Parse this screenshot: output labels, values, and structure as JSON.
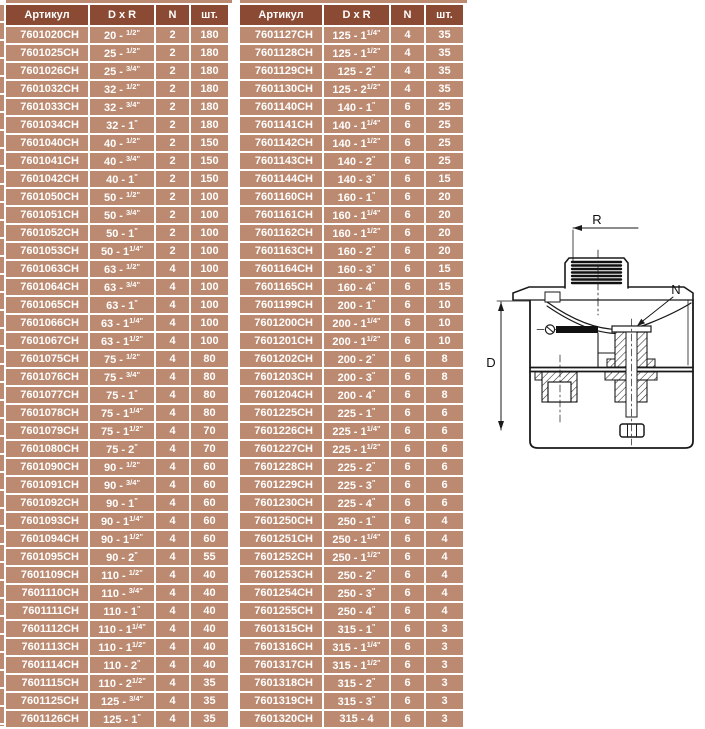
{
  "page": {
    "background": "#ffffff",
    "language": "ru"
  },
  "colors": {
    "header_bg": "#8b4a33",
    "row_bg": "#bc8a70",
    "separator": "#ffffff",
    "header_text": "#ffffff",
    "row_text": "#ffffff",
    "drawing_line": "#1a1a1a"
  },
  "tables": {
    "headers": [
      "Артикул",
      "D x R",
      "N",
      "шт."
    ],
    "left": {
      "rows": [
        [
          "7601020CH",
          "20 - {1/2\"}",
          "2",
          "180"
        ],
        [
          "7601025CH",
          "25 - {1/2\"}",
          "2",
          "180"
        ],
        [
          "7601026CH",
          "25 - {3/4\"}",
          "2",
          "180"
        ],
        [
          "7601032CH",
          "32 - {1/2\"}",
          "2",
          "180"
        ],
        [
          "7601033CH",
          "32 - {3/4\"}",
          "2",
          "180"
        ],
        [
          "7601034CH",
          "32 - 1{\"}",
          "2",
          "180"
        ],
        [
          "7601040CH",
          "40 - {1/2\"}",
          "2",
          "150"
        ],
        [
          "7601041CH",
          "40 - {3/4\"}",
          "2",
          "150"
        ],
        [
          "7601042CH",
          "40 - 1{\"}",
          "2",
          "150"
        ],
        [
          "7601050CH",
          "50 - {1/2\"}",
          "2",
          "100"
        ],
        [
          "7601051CH",
          "50 - {3/4\"}",
          "2",
          "100"
        ],
        [
          "7601052CH",
          "50 - 1{\"}",
          "2",
          "100"
        ],
        [
          "7601053CH",
          "50 - 1{1/4\"}",
          "2",
          "100"
        ],
        [
          "7601063CH",
          "63 - {1/2\"}",
          "4",
          "100"
        ],
        [
          "7601064CH",
          "63 - {3/4\"}",
          "4",
          "100"
        ],
        [
          "7601065CH",
          "63 - 1{\"}",
          "4",
          "100"
        ],
        [
          "7601066CH",
          "63 - 1{1/4\"}",
          "4",
          "100"
        ],
        [
          "7601067CH",
          "63 - 1{1/2\"}",
          "4",
          "100"
        ],
        [
          "7601075CH",
          "75 - {1/2\"}",
          "4",
          "80"
        ],
        [
          "7601076CH",
          "75 - {3/4\"}",
          "4",
          "80"
        ],
        [
          "7601077CH",
          "75 - 1{\"}",
          "4",
          "80"
        ],
        [
          "7601078CH",
          "75 - 1{1/4\"}",
          "4",
          "80"
        ],
        [
          "7601079CH",
          "75 - 1{1/2\"}",
          "4",
          "70"
        ],
        [
          "7601080CH",
          "75 - 2{\"}",
          "4",
          "70"
        ],
        [
          "7601090CH",
          "90 - {1/2\"}",
          "4",
          "60"
        ],
        [
          "7601091CH",
          "90 - {3/4\"}",
          "4",
          "60"
        ],
        [
          "7601092CH",
          "90 - 1{\"}",
          "4",
          "60"
        ],
        [
          "7601093CH",
          "90 - 1{1/4\"}",
          "4",
          "60"
        ],
        [
          "7601094CH",
          "90 - 1{1/2\"}",
          "4",
          "60"
        ],
        [
          "7601095CH",
          "90 - 2{\"}",
          "4",
          "55"
        ],
        [
          "7601109CH",
          "110 - {1/2\"}",
          "4",
          "40"
        ],
        [
          "7601110CH",
          "110 - {3/4\"}",
          "4",
          "40"
        ],
        [
          "7601111CH",
          "110 - 1{\"}",
          "4",
          "40"
        ],
        [
          "7601112CH",
          "110 - 1{1/4\"}",
          "4",
          "40"
        ],
        [
          "7601113CH",
          "110 - 1{1/2\"}",
          "4",
          "40"
        ],
        [
          "7601114CH",
          "110 - 2{\"}",
          "4",
          "40"
        ],
        [
          "7601115CH",
          "110 - 2{1/2\"}",
          "4",
          "35"
        ],
        [
          "7601125CH",
          "125 - {3/4\"}",
          "4",
          "35"
        ],
        [
          "7601126CH",
          "125 - 1{\"}",
          "4",
          "35"
        ]
      ]
    },
    "right": {
      "rows": [
        [
          "7601127CH",
          "125 - 1{1/4\"}",
          "4",
          "35"
        ],
        [
          "7601128CH",
          "125 - 1{1/2\"}",
          "4",
          "35"
        ],
        [
          "7601129CH",
          "125 - 2{\"}",
          "4",
          "35"
        ],
        [
          "7601130CH",
          "125 - 2{1/2\"}",
          "4",
          "35"
        ],
        [
          "7601140CH",
          "140 - 1{\"}",
          "6",
          "25"
        ],
        [
          "7601141CH",
          "140 - 1{1/4\"}",
          "6",
          "25"
        ],
        [
          "7601142CH",
          "140 - 1{1/2\"}",
          "6",
          "25"
        ],
        [
          "7601143CH",
          "140 - 2{\"}",
          "6",
          "25"
        ],
        [
          "7601144CH",
          "140 - 3{\"}",
          "6",
          "15"
        ],
        [
          "7601160CH",
          "160 - 1{\"}",
          "6",
          "20"
        ],
        [
          "7601161CH",
          "160 - 1{1/4\"}",
          "6",
          "20"
        ],
        [
          "7601162CH",
          "160 - 1{1/2\"}",
          "6",
          "20"
        ],
        [
          "7601163CH",
          "160 - 2{\"}",
          "6",
          "20"
        ],
        [
          "7601164CH",
          "160 - 3{\"}",
          "6",
          "15"
        ],
        [
          "7601165CH",
          "160 - 4{\"}",
          "6",
          "15"
        ],
        [
          "7601199CH",
          "200 - 1{\"}",
          "6",
          "10"
        ],
        [
          "7601200CH",
          "200 - 1{1/4\"}",
          "6",
          "10"
        ],
        [
          "7601201CH",
          "200 - 1{1/2\"}",
          "6",
          "10"
        ],
        [
          "7601202CH",
          "200 - 2{\"}",
          "6",
          "8"
        ],
        [
          "7601203CH",
          "200 - 3{\"}",
          "6",
          "8"
        ],
        [
          "7601204CH",
          "200 - 4{\"}",
          "6",
          "8"
        ],
        [
          "7601225CH",
          "225 - 1{\"}",
          "6",
          "6"
        ],
        [
          "7601226CH",
          "225 - 1{1/4\"}",
          "6",
          "6"
        ],
        [
          "7601227CH",
          "225 - 1{1/2\"}",
          "6",
          "6"
        ],
        [
          "7601228CH",
          "225 - 2{\"}",
          "6",
          "6"
        ],
        [
          "7601229CH",
          "225 - 3{\"}",
          "6",
          "6"
        ],
        [
          "7601230CH",
          "225 - 4{\"}",
          "6",
          "6"
        ],
        [
          "7601250CH",
          "250 - 1{\"}",
          "6",
          "4"
        ],
        [
          "7601251CH",
          "250 - 1{1/4\"}",
          "6",
          "4"
        ],
        [
          "7601252CH",
          "250 - 1{1/2\"}",
          "6",
          "4"
        ],
        [
          "7601253CH",
          "250 - 2{\"}",
          "6",
          "4"
        ],
        [
          "7601254CH",
          "250 - 3{\"}",
          "6",
          "4"
        ],
        [
          "7601255CH",
          "250 - 4{\"}",
          "6",
          "4"
        ],
        [
          "7601315CH",
          "315 - 1{\"}",
          "6",
          "3"
        ],
        [
          "7601316CH",
          "315 - 1{1/4\"}",
          "6",
          "3"
        ],
        [
          "7601317CH",
          "315 - 1{1/2\"}",
          "6",
          "3"
        ],
        [
          "7601318CH",
          "315 - 2{\"}",
          "6",
          "3"
        ],
        [
          "7601319CH",
          "315 - 3{\"}",
          "6",
          "3"
        ],
        [
          "7601320CH",
          "315 - 4",
          "6",
          "3"
        ]
      ]
    }
  },
  "diagram": {
    "type": "cross-section technical drawing of pipe saddle clamp",
    "labels": {
      "r": "R",
      "d": "D",
      "n": "N"
    }
  }
}
